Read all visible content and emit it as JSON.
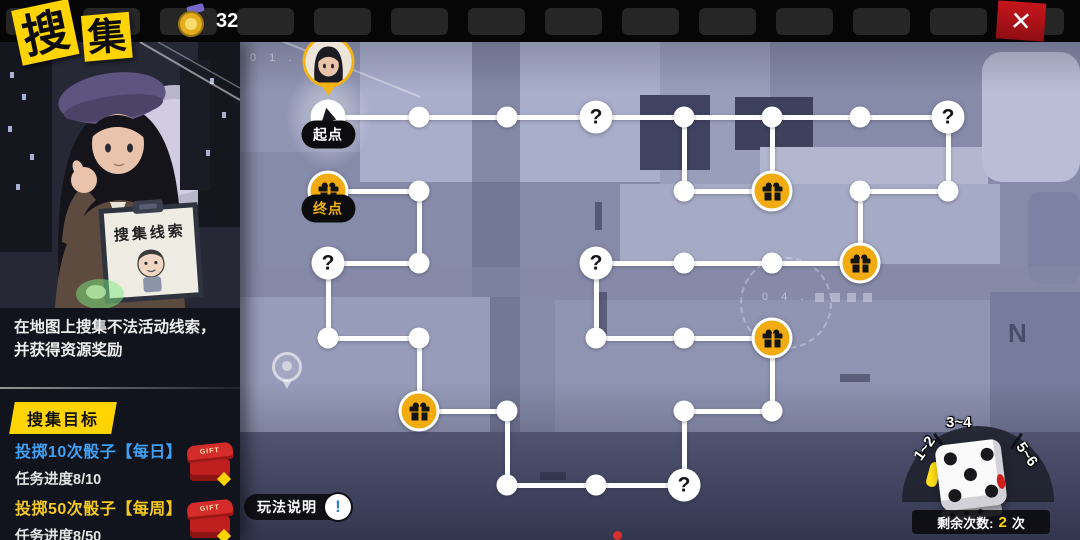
{
  "header": {
    "title_chars": [
      "搜",
      "集"
    ],
    "currency": {
      "icon": "badge-icon",
      "value": "32"
    },
    "close_glyph": "✕"
  },
  "left_panel": {
    "sign_text": "搜集线索",
    "description_line1": "在地图上搜集不法活动线索，",
    "description_line2": "并获得资源奖励",
    "goal_header": "搜集目标",
    "gift_tag": "GIFT",
    "tasks": [
      {
        "title": "投掷10次骰子【每日】",
        "progress": "任务进度8/10"
      },
      {
        "title": "投掷50次骰子【每周】",
        "progress": "任务进度8/50"
      }
    ]
  },
  "map": {
    "help_label": "玩法说明",
    "help_icon_glyph": "!",
    "bg_labels": {
      "top_left": "0 1 .",
      "street": "0 4 .",
      "letters": "N D"
    }
  },
  "board": {
    "question_glyph": "?",
    "start_label": "起点",
    "end_label": "终点",
    "nodes": [
      {
        "x": 88,
        "y": 75,
        "t": "start",
        "label": "起点"
      },
      {
        "x": 179,
        "y": 75,
        "t": "dot"
      },
      {
        "x": 267,
        "y": 75,
        "t": "dot"
      },
      {
        "x": 356,
        "y": 75,
        "t": "q"
      },
      {
        "x": 444,
        "y": 75,
        "t": "dot"
      },
      {
        "x": 532,
        "y": 75,
        "t": "dot"
      },
      {
        "x": 620,
        "y": 75,
        "t": "dot"
      },
      {
        "x": 708,
        "y": 75,
        "t": "q"
      },
      {
        "x": 88,
        "y": 149,
        "t": "gift",
        "label": "终点"
      },
      {
        "x": 179,
        "y": 149,
        "t": "dot"
      },
      {
        "x": 444,
        "y": 149,
        "t": "dot"
      },
      {
        "x": 532,
        "y": 149,
        "t": "gift"
      },
      {
        "x": 620,
        "y": 149,
        "t": "dot"
      },
      {
        "x": 708,
        "y": 149,
        "t": "dot"
      },
      {
        "x": 88,
        "y": 221,
        "t": "q"
      },
      {
        "x": 179,
        "y": 221,
        "t": "dot"
      },
      {
        "x": 356,
        "y": 221,
        "t": "q"
      },
      {
        "x": 444,
        "y": 221,
        "t": "dot"
      },
      {
        "x": 532,
        "y": 221,
        "t": "dot"
      },
      {
        "x": 620,
        "y": 221,
        "t": "gift"
      },
      {
        "x": 88,
        "y": 296,
        "t": "dot"
      },
      {
        "x": 179,
        "y": 296,
        "t": "dot"
      },
      {
        "x": 356,
        "y": 296,
        "t": "dot"
      },
      {
        "x": 444,
        "y": 296,
        "t": "dot"
      },
      {
        "x": 532,
        "y": 296,
        "t": "gift"
      },
      {
        "x": 179,
        "y": 369,
        "t": "gift"
      },
      {
        "x": 267,
        "y": 369,
        "t": "dot"
      },
      {
        "x": 444,
        "y": 369,
        "t": "dot"
      },
      {
        "x": 532,
        "y": 369,
        "t": "dot"
      },
      {
        "x": 267,
        "y": 443,
        "t": "dot"
      },
      {
        "x": 356,
        "y": 443,
        "t": "dot"
      },
      {
        "x": 444,
        "y": 443,
        "t": "q"
      }
    ],
    "edges": [
      {
        "x1": 88,
        "y1": 75,
        "x2": 708,
        "y2": 75
      },
      {
        "x1": 88,
        "y1": 149,
        "x2": 179,
        "y2": 149
      },
      {
        "x1": 444,
        "y1": 149,
        "x2": 532,
        "y2": 149
      },
      {
        "x1": 620,
        "y1": 149,
        "x2": 708,
        "y2": 149
      },
      {
        "x1": 88,
        "y1": 221,
        "x2": 179,
        "y2": 221
      },
      {
        "x1": 356,
        "y1": 221,
        "x2": 620,
        "y2": 221
      },
      {
        "x1": 88,
        "y1": 296,
        "x2": 179,
        "y2": 296
      },
      {
        "x1": 356,
        "y1": 296,
        "x2": 532,
        "y2": 296
      },
      {
        "x1": 179,
        "y1": 369,
        "x2": 267,
        "y2": 369
      },
      {
        "x1": 444,
        "y1": 369,
        "x2": 532,
        "y2": 369
      },
      {
        "x1": 267,
        "y1": 443,
        "x2": 444,
        "y2": 443
      },
      {
        "x1": 444,
        "y1": 75,
        "x2": 444,
        "y2": 149
      },
      {
        "x1": 532,
        "y1": 75,
        "x2": 532,
        "y2": 149
      },
      {
        "x1": 708,
        "y1": 75,
        "x2": 708,
        "y2": 149
      },
      {
        "x1": 179,
        "y1": 149,
        "x2": 179,
        "y2": 221
      },
      {
        "x1": 620,
        "y1": 149,
        "x2": 620,
        "y2": 221
      },
      {
        "x1": 88,
        "y1": 221,
        "x2": 88,
        "y2": 296
      },
      {
        "x1": 356,
        "y1": 221,
        "x2": 356,
        "y2": 296
      },
      {
        "x1": 179,
        "y1": 296,
        "x2": 179,
        "y2": 369
      },
      {
        "x1": 532,
        "y1": 296,
        "x2": 532,
        "y2": 369
      },
      {
        "x1": 267,
        "y1": 369,
        "x2": 267,
        "y2": 443
      },
      {
        "x1": 444,
        "y1": 369,
        "x2": 444,
        "y2": 443
      }
    ]
  },
  "dice": {
    "segments": [
      "1~2",
      "3~4",
      "5~6"
    ],
    "remaining_label": "剩余次数:",
    "remaining_value": "2",
    "remaining_unit": "次"
  },
  "colors": {
    "accent_yellow": "#ffd400",
    "gift_node": "#f2ab10",
    "task_daily_blue": "#3fa1f5",
    "task_weekly_yellow": "#f6c91e",
    "close_red": "#b5151b",
    "help_bang_blue": "#2f7fd6"
  }
}
